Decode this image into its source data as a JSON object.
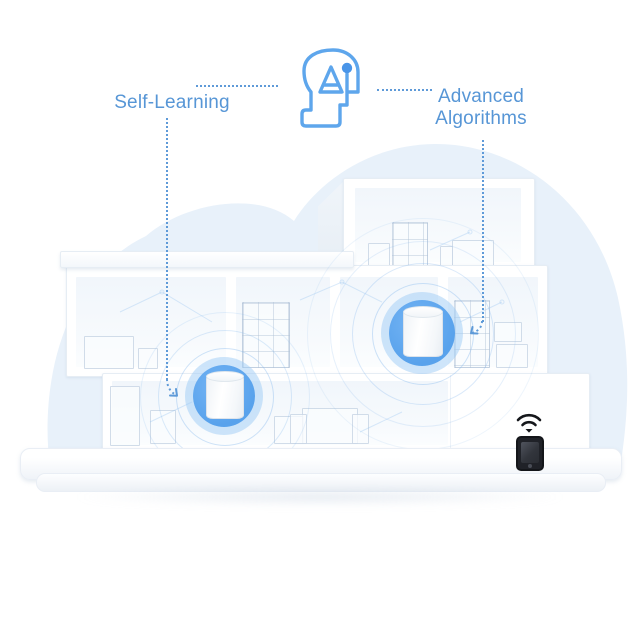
{
  "callouts": {
    "left_label": "Self-Learning",
    "right_label": "Advanced Algorithms"
  },
  "icons": {
    "top_center": "ai-head-icon",
    "bottom_right": [
      "wifi-icon",
      "smartphone-icon"
    ]
  },
  "scene": {
    "mesh_units_visible": 2,
    "floors_visible": 3
  },
  "colors": {
    "label_text": "#5796d6",
    "leader_line": "#5e9ad8",
    "icon_stroke": "#5ea6ec",
    "deco_circle_blue": "#5da2ec",
    "deco_halo": "#9ecbf6",
    "cloud_fill": "#e8f1fa",
    "house_white": "#ffffff",
    "phone_black": "#1b1d22"
  }
}
